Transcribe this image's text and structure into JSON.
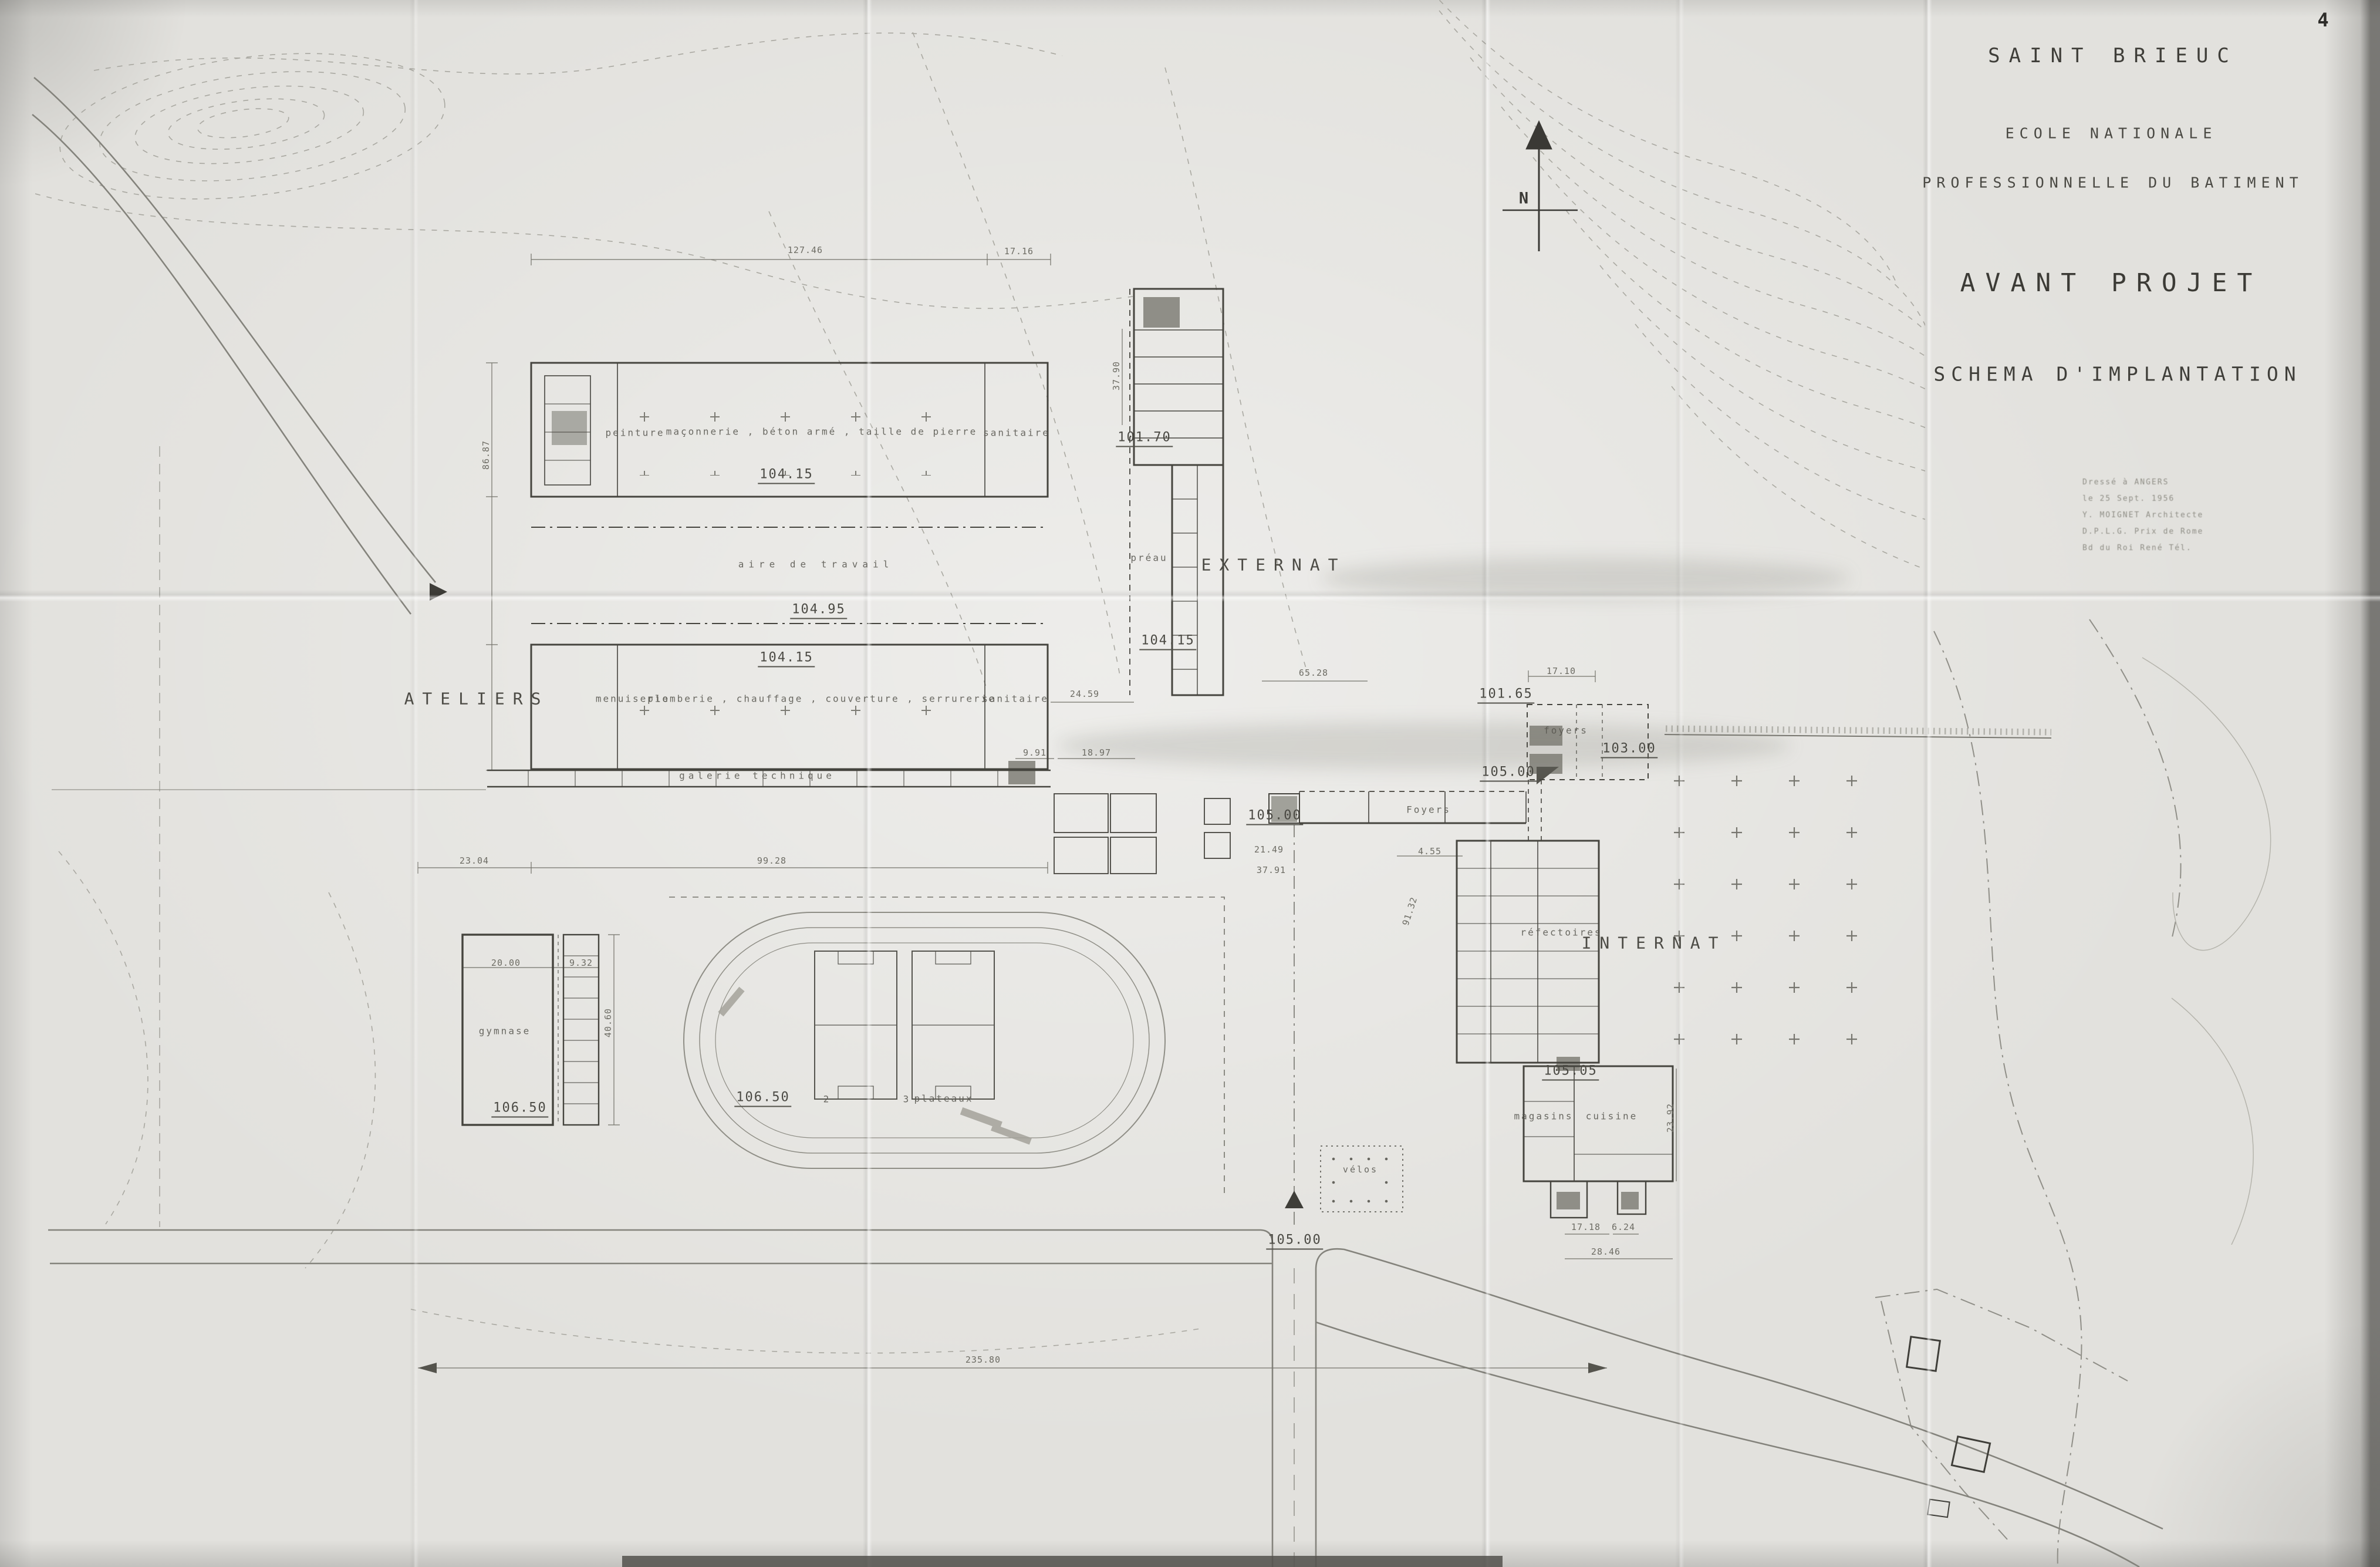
{
  "page": {
    "number": "4"
  },
  "title_block": {
    "city": "SAINT BRIEUC",
    "school_line1": "ECOLE NATIONALE",
    "school_line2": "PROFESSIONNELLE DU BATIMENT",
    "project": "AVANT PROJET",
    "subtitle": "SCHEMA D'IMPLANTATION",
    "notes": {
      "l1": "Dressé à ANGERS",
      "l2": "le 25 Sept. 1956",
      "l3": "Y. MOIGNET  Architecte",
      "l4": "D.P.L.G.  Prix de Rome",
      "l5": "Bd du Roi René  Tél."
    }
  },
  "compass": {
    "north": "N"
  },
  "zones": {
    "ateliers": "ATELIERS",
    "externat": "EXTERNAT",
    "internat": "INTERNAT"
  },
  "rooms": {
    "peinture": "peinture",
    "gros_oeuvre": "maçonnerie , béton armé , taille de pierre",
    "sanitaire_nord": "sanitaire",
    "aire_travail": "aire de travail",
    "menuiserie": "menuiserie",
    "second_oeuvre": "plomberie , chauffage , couverture , serrurerie",
    "sanitaire_sud": "sanitaire",
    "galerie": "galerie technique",
    "preau": "préau",
    "foyers_externat": "Foyers",
    "foyers_internat": "foyers",
    "refectoires": "réfectoires",
    "magasins": "magasins",
    "cuisine": "cuisine",
    "gymnase": "gymnase",
    "plateaux": "plateaux",
    "velos": "vélos",
    "plateau_2": "2",
    "plateau_3": "3"
  },
  "levels": {
    "ateliers_nord": "104.15",
    "aire": "104.95",
    "ateliers_sud": "104.15",
    "batiment_nord": "101.70",
    "entree_nord": "101.65",
    "cour_est": "103.00",
    "foyers": "105.00",
    "externat": "105.00",
    "cuisine": "105.05",
    "gymnase": "106.50",
    "stade": "106.50",
    "route": "105.00"
  },
  "dims": {
    "d_127_46": "127.46",
    "d_17_16": "17.16",
    "d_65_28": "65.28",
    "d_24_59": "24.59",
    "d_17_10": "17.10",
    "d_9_91": "9.91",
    "d_18_97": "18.97",
    "d_99_28": "99.28",
    "d_23_04": "23.04",
    "d_21_49": "21.49",
    "d_4_55": "4.55",
    "d_37_91": "37.91",
    "d_235_80": "235.80",
    "d_20_00": "20.00",
    "d_9_32": "9.32",
    "d_17_18": "17.18",
    "d_6_24": "6.24",
    "d_28_46": "28.46",
    "d_40_60": "40.60",
    "d_23_92": "23.92",
    "d_37_90": "37.90",
    "d_86_87": "86.87",
    "d_91_32": "91.32"
  }
}
